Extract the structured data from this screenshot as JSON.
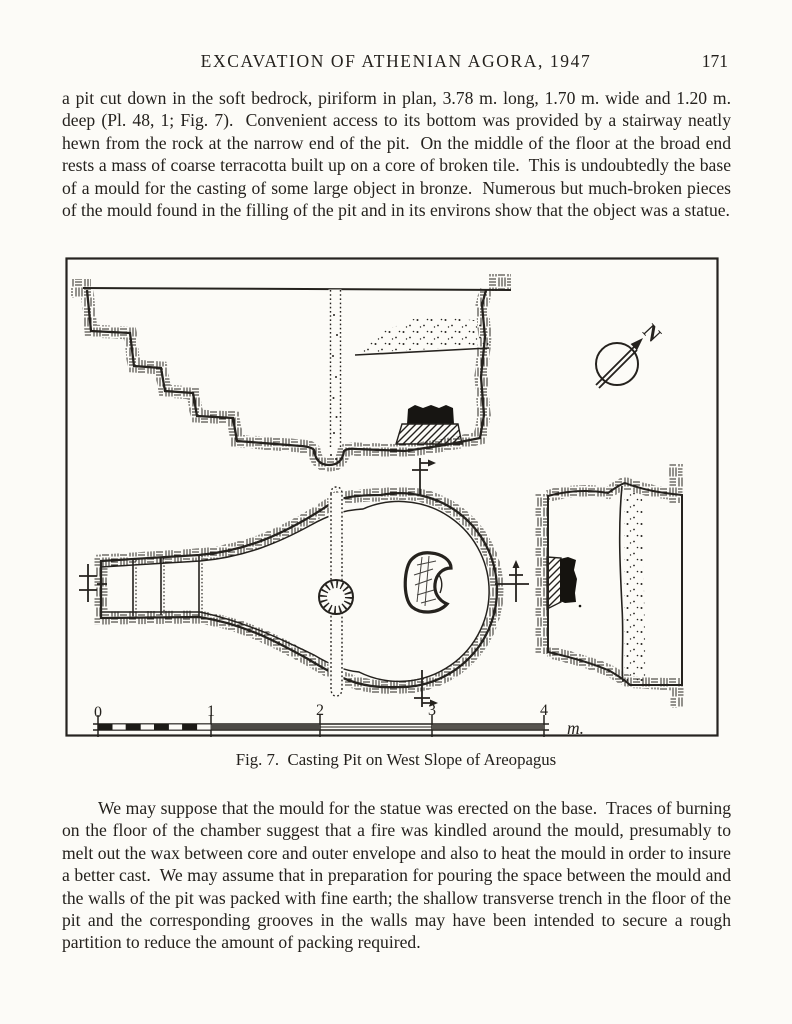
{
  "header": {
    "title": "EXCAVATION OF ATHENIAN AGORA, 1947",
    "page_number": "171"
  },
  "paragraphs": {
    "p1": "a pit cut down in the soft bedrock, piriform in plan, 3.78 m. long, 1.70 m. wide and 1.20 m. deep (Pl. 48, 1; Fig. 7).  Convenient access to its bottom was provided by a stairway neatly hewn from the rock at the narrow end of the pit.  On the middle of the floor at the broad end rests a mass of coarse terracotta built up on a core of broken tile.  This is undoubtedly the base of a mould for the casting of some large object in bronze.  Numerous but much-broken pieces of the mould found in the filling of the pit and in its environs show that the object was a statue.",
    "p2": "We may suppose that the mould for the statue was erected on the base.  Traces of burning on the floor of the chamber suggest that a fire was kindled around the mould, presumably to melt out the wax between core and outer envelope and also to heat the mould in order to insure a better cast.  We may assume that in preparation for pouring the space between the mould and the walls of the pit was packed with fine earth; the shallow transverse trench in the floor of the pit and the corresponding grooves in the walls may have been intended to secure a rough partition to reduce the amount of packing required."
  },
  "figure": {
    "caption": "Fig. 7.  Casting Pit on West Slope of Areopagus",
    "north_label": "N",
    "scale": {
      "labels": [
        "0",
        "1",
        "2",
        "3",
        "4"
      ],
      "unit": "m."
    }
  },
  "colors": {
    "paper": "#fcfbf7",
    "ink": "#24211d"
  }
}
